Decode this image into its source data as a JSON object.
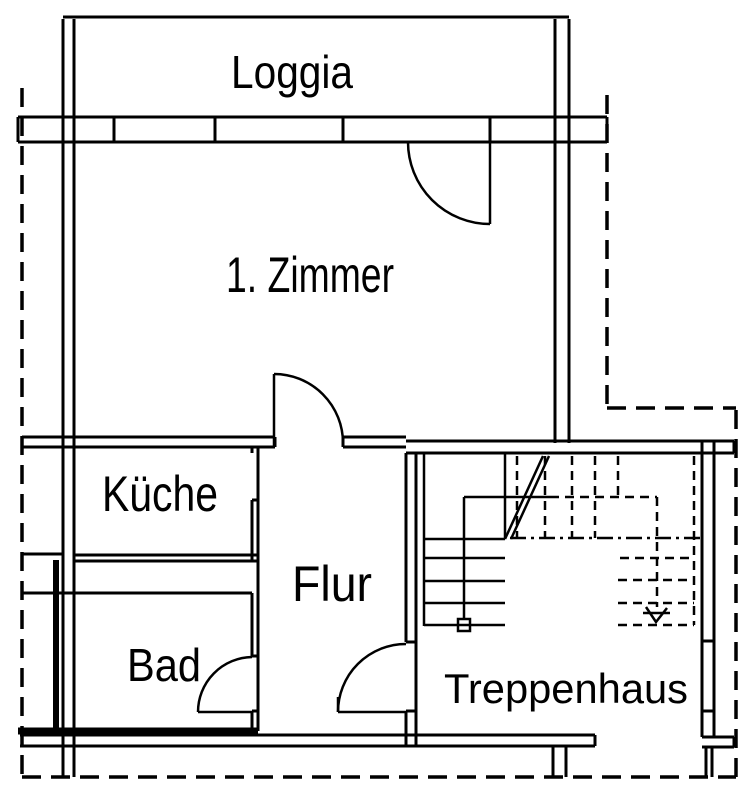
{
  "page": {
    "type": "architectural-floor-plan",
    "background_color": "#ffffff",
    "line_color": "#000000"
  },
  "rooms": [
    {
      "id": "loggia",
      "label": "Loggia"
    },
    {
      "id": "zimmer",
      "label": "1. Zimmer"
    },
    {
      "id": "kueche",
      "label": "Küche"
    },
    {
      "id": "flur",
      "label": "Flur"
    },
    {
      "id": "bad",
      "label": "Bad"
    },
    {
      "id": "treppenhaus",
      "label": "Treppenhaus"
    }
  ],
  "stairs": {
    "direction_arrow": "down"
  }
}
